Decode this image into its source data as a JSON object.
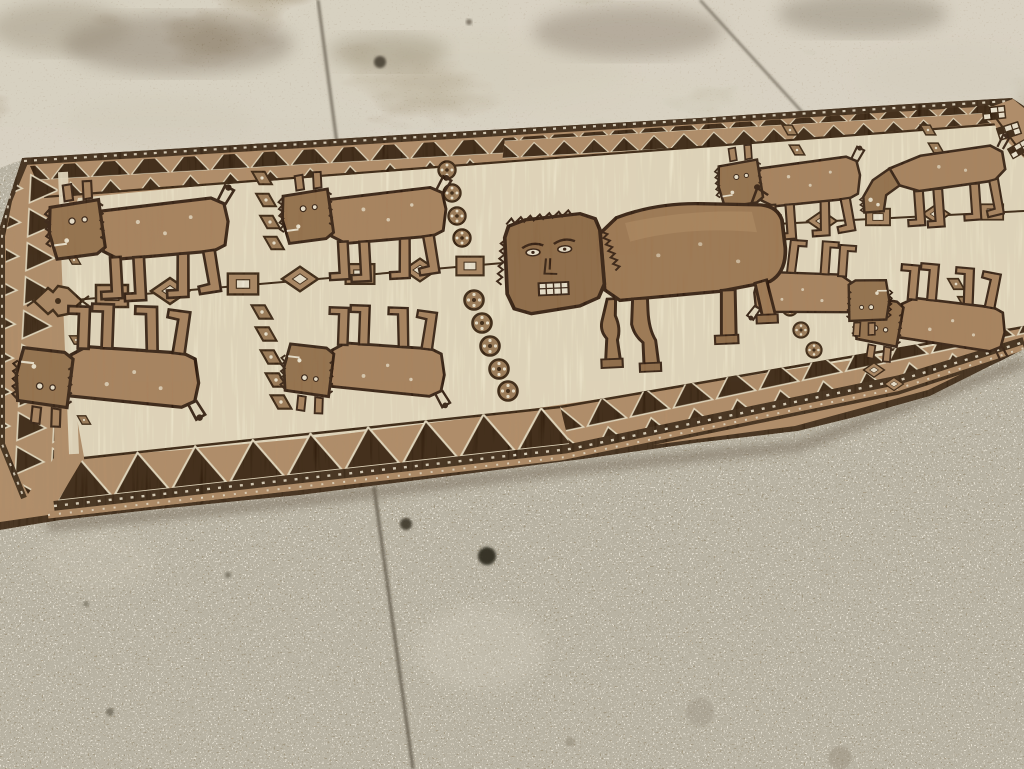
{
  "image": {
    "width": 1024,
    "height": 769,
    "subject": "Tribal pictorial runner rug with bull figures, laid diagonally on a concrete floor"
  },
  "palette": {
    "floor_top": "#a29479",
    "floor_bottom": "#b2a389",
    "speckle_light": "#ece5d3",
    "speckle_dark": "#4e4738",
    "seam": "#5d5547",
    "rug_outer_dark": "#3a2817",
    "rug_border_tan": "#b28e6a",
    "rug_field": "#eae1c7",
    "motif_dark": "#33200f",
    "motif_tan": "#a88360",
    "animal_body": "#a8835f",
    "animal_head": "#93704c",
    "bull_body": "#9d7853",
    "bull_head": "#8c6946",
    "accent_white": "#f0e9d6",
    "shadow": "#6f6452"
  },
  "floor": {
    "seams": [
      {
        "x1": 318,
        "y1": 0,
        "x2": 337,
        "y2": 144,
        "w": 2.5
      },
      {
        "x1": 700,
        "y1": 0,
        "x2": 803,
        "y2": 113,
        "w": 2
      },
      {
        "x1": 374,
        "y1": 487,
        "x2": 413,
        "y2": 769,
        "w": 3
      }
    ],
    "spots": [
      {
        "x": 380,
        "y": 62,
        "r": 6,
        "c": "#4a4236",
        "o": 0.9
      },
      {
        "x": 469,
        "y": 22,
        "r": 3,
        "c": "#6a6253",
        "o": 0.8
      },
      {
        "x": 406,
        "y": 524,
        "r": 6,
        "c": "#3e382c",
        "o": 0.9
      },
      {
        "x": 487,
        "y": 556,
        "r": 9,
        "c": "#332e24",
        "o": 0.95
      },
      {
        "x": 110,
        "y": 712,
        "r": 4,
        "c": "#55503f",
        "o": 0.6
      },
      {
        "x": 228,
        "y": 575,
        "r": 3,
        "c": "#5a5444",
        "o": 0.6
      },
      {
        "x": 86,
        "y": 604,
        "r": 3,
        "c": "#5a5444",
        "o": 0.5
      },
      {
        "x": 840,
        "y": 758,
        "r": 12,
        "c": "#968c7a",
        "o": 0.45
      },
      {
        "x": 700,
        "y": 712,
        "r": 14,
        "c": "#9a9181",
        "o": 0.4
      },
      {
        "x": 570,
        "y": 742,
        "r": 5,
        "c": "#8e8573",
        "o": 0.5
      }
    ],
    "stains": [
      {
        "x": 480,
        "y": 72,
        "rx": 150,
        "ry": 38,
        "c": "#d3ccba",
        "o": 0.5
      },
      {
        "x": 645,
        "y": 108,
        "rx": 120,
        "ry": 30,
        "c": "#d8d2c0",
        "o": 0.45
      },
      {
        "x": 952,
        "y": 78,
        "rx": 95,
        "ry": 36,
        "c": "#d3ccbc",
        "o": 0.5
      },
      {
        "x": 160,
        "y": 122,
        "rx": 95,
        "ry": 26,
        "c": "#cfc8b6",
        "o": 0.4
      },
      {
        "x": 300,
        "y": 142,
        "rx": 85,
        "ry": 20,
        "c": "#d3ccba",
        "o": 0.35
      },
      {
        "x": 178,
        "y": 44,
        "rx": 115,
        "ry": 30,
        "c": "#8d8171",
        "o": 0.5
      },
      {
        "x": 628,
        "y": 32,
        "rx": 95,
        "ry": 26,
        "c": "#8d8171",
        "o": 0.45
      },
      {
        "x": 862,
        "y": 14,
        "rx": 85,
        "ry": 22,
        "c": "#898070",
        "o": 0.45
      },
      {
        "x": 388,
        "y": 52,
        "rx": 60,
        "ry": 18,
        "c": "#93886f",
        "o": 0.4
      },
      {
        "x": 60,
        "y": 28,
        "rx": 70,
        "ry": 26,
        "c": "#968b77",
        "o": 0.4
      },
      {
        "x": 480,
        "y": 648,
        "rx": 64,
        "ry": 42,
        "c": "#d8d2c2",
        "o": 0.3
      },
      {
        "x": 96,
        "y": 560,
        "rx": 60,
        "ry": 30,
        "c": "#cfc8b6",
        "o": 0.25
      }
    ]
  },
  "rug": {
    "animal_count_small": 8,
    "animal_count_large": 1,
    "animals": [
      {
        "name": "bull-top-1",
        "ref": "bull-small",
        "x": 62,
        "y": 192,
        "s": 1.06,
        "r": -3
      },
      {
        "name": "bull-top-2",
        "ref": "bull-small",
        "x": 294,
        "y": 182,
        "s": 0.97,
        "r": -3
      },
      {
        "name": "bull-top-3",
        "ref": "bull-small",
        "x": 728,
        "y": 154,
        "s": 0.84,
        "r": -4
      },
      {
        "name": "bull-top-grazing",
        "ref": "bull-grazing",
        "x": 858,
        "y": 146,
        "s": 0.88,
        "r": -4
      },
      {
        "name": "bull-bottom-1",
        "ref": "bull-small",
        "x": 30,
        "y": 416,
        "s": 1.08,
        "r": 2,
        "flip": true
      },
      {
        "name": "bull-bottom-2",
        "ref": "bull-small",
        "x": 296,
        "y": 404,
        "s": 0.95,
        "r": 2,
        "flip": true
      },
      {
        "name": "bull-bottom-3",
        "ref": "bull-small",
        "x": 866,
        "y": 352,
        "s": 0.88,
        "r": 5,
        "flip": true
      },
      {
        "name": "bull-bottom-4",
        "ref": "bull-small",
        "x": 876,
        "y": 330,
        "s": 0.8,
        "r": 184
      },
      {
        "name": "bull-central",
        "ref": "bull-central",
        "x": 497,
        "y": 206,
        "sx": 1.06,
        "sy": 0.94,
        "r": -2.5
      }
    ],
    "chains": {
      "left": {
        "x1": 40,
        "y1": 303,
        "x2": 503,
        "y2": 263,
        "beads": [
          {
            "t": "hook",
            "x": 58,
            "y": 301,
            "s": 1.0
          },
          {
            "t": "rect",
            "x": 112,
            "y": 296,
            "s": 1.0
          },
          {
            "t": "diamond",
            "x": 170,
            "y": 291,
            "s": 1.0
          },
          {
            "t": "rect",
            "x": 243,
            "y": 284,
            "s": 0.95
          },
          {
            "t": "diamond",
            "x": 300,
            "y": 279,
            "s": 0.95
          },
          {
            "t": "rect",
            "x": 360,
            "y": 274,
            "s": 0.9
          },
          {
            "t": "diamond",
            "x": 420,
            "y": 270,
            "s": 0.88
          },
          {
            "t": "rect",
            "x": 470,
            "y": 266,
            "s": 0.85
          }
        ]
      },
      "right": {
        "x1": 757,
        "y1": 225,
        "x2": 1024,
        "y2": 211,
        "beads": [
          {
            "t": "rect",
            "x": 768,
            "y": 224,
            "s": 0.8
          },
          {
            "t": "diamond",
            "x": 822,
            "y": 221,
            "s": 0.78
          },
          {
            "t": "rect",
            "x": 878,
            "y": 217,
            "s": 0.75
          },
          {
            "t": "diamond",
            "x": 936,
            "y": 214,
            "s": 0.72
          },
          {
            "t": "rect",
            "x": 992,
            "y": 212,
            "s": 0.7
          }
        ]
      }
    },
    "motifs": [
      {
        "ref": "smotif",
        "x": 262,
        "y": 178,
        "s": 0.9
      },
      {
        "ref": "smotif",
        "x": 266,
        "y": 200,
        "s": 0.9
      },
      {
        "ref": "smotif",
        "x": 270,
        "y": 222,
        "s": 0.9
      },
      {
        "ref": "smotif",
        "x": 274,
        "y": 243,
        "s": 0.9
      },
      {
        "ref": "smotif",
        "x": 262,
        "y": 312,
        "s": 0.95
      },
      {
        "ref": "smotif",
        "x": 266,
        "y": 334,
        "s": 0.95
      },
      {
        "ref": "smotif",
        "x": 271,
        "y": 357,
        "s": 0.95
      },
      {
        "ref": "smotif",
        "x": 276,
        "y": 380,
        "s": 0.95
      },
      {
        "ref": "smotif",
        "x": 281,
        "y": 402,
        "s": 0.95
      },
      {
        "ref": "rosette",
        "x": 447,
        "y": 170,
        "s": 0.9
      },
      {
        "ref": "rosette",
        "x": 452,
        "y": 193,
        "s": 0.9
      },
      {
        "ref": "rosette",
        "x": 457,
        "y": 216,
        "s": 0.9
      },
      {
        "ref": "rosette",
        "x": 462,
        "y": 238,
        "s": 0.9
      },
      {
        "ref": "rosette",
        "x": 474,
        "y": 300,
        "s": 1.0
      },
      {
        "ref": "rosette",
        "x": 482,
        "y": 323,
        "s": 1.0
      },
      {
        "ref": "rosette",
        "x": 490,
        "y": 346,
        "s": 1.0
      },
      {
        "ref": "rosette",
        "x": 499,
        "y": 369,
        "s": 1.0
      },
      {
        "ref": "rosette",
        "x": 508,
        "y": 391,
        "s": 1.0
      },
      {
        "ref": "smotif",
        "x": 790,
        "y": 130,
        "s": 0.7
      },
      {
        "ref": "smotif",
        "x": 797,
        "y": 150,
        "s": 0.7
      },
      {
        "ref": "smotif",
        "x": 804,
        "y": 170,
        "s": 0.7
      },
      {
        "ref": "smotif",
        "x": 811,
        "y": 190,
        "s": 0.7
      },
      {
        "ref": "rosette",
        "x": 768,
        "y": 264,
        "s": 0.8
      },
      {
        "ref": "rosette",
        "x": 779,
        "y": 286,
        "s": 0.8
      },
      {
        "ref": "rosette",
        "x": 790,
        "y": 308,
        "s": 0.8
      },
      {
        "ref": "rosette",
        "x": 801,
        "y": 330,
        "s": 0.8
      },
      {
        "ref": "rosette",
        "x": 814,
        "y": 350,
        "s": 0.8
      },
      {
        "ref": "smotif",
        "x": 928,
        "y": 130,
        "s": 0.7
      },
      {
        "ref": "smotif",
        "x": 936,
        "y": 148,
        "s": 0.7
      },
      {
        "ref": "smotif",
        "x": 944,
        "y": 166,
        "s": 0.7
      },
      {
        "ref": "smotif",
        "x": 956,
        "y": 284,
        "s": 0.75
      },
      {
        "ref": "smotif",
        "x": 966,
        "y": 302,
        "s": 0.75
      },
      {
        "ref": "smotif",
        "x": 976,
        "y": 320,
        "s": 0.75
      },
      {
        "ref": "bead-diamond",
        "x": 874,
        "y": 370,
        "s": 0.55
      },
      {
        "ref": "bead-diamond",
        "x": 894,
        "y": 384,
        "s": 0.5
      },
      {
        "ref": "smotif",
        "x": 76,
        "y": 220,
        "s": 0.6
      },
      {
        "ref": "smotif",
        "x": 74,
        "y": 260,
        "s": 0.6
      },
      {
        "ref": "smotif",
        "x": 74,
        "y": 300,
        "s": 0.6
      },
      {
        "ref": "smotif",
        "x": 76,
        "y": 340,
        "s": 0.6
      },
      {
        "ref": "smotif",
        "x": 80,
        "y": 380,
        "s": 0.6
      },
      {
        "ref": "smotif",
        "x": 84,
        "y": 420,
        "s": 0.6
      },
      {
        "ref": "checkerbox",
        "x": 994,
        "y": 113,
        "r": -6,
        "s": 1
      },
      {
        "ref": "checkerbox",
        "x": 1009,
        "y": 131,
        "r": -18,
        "s": 1
      },
      {
        "ref": "checkerbox",
        "x": 1019,
        "y": 149,
        "r": -30,
        "s": 0.9
      }
    ]
  }
}
